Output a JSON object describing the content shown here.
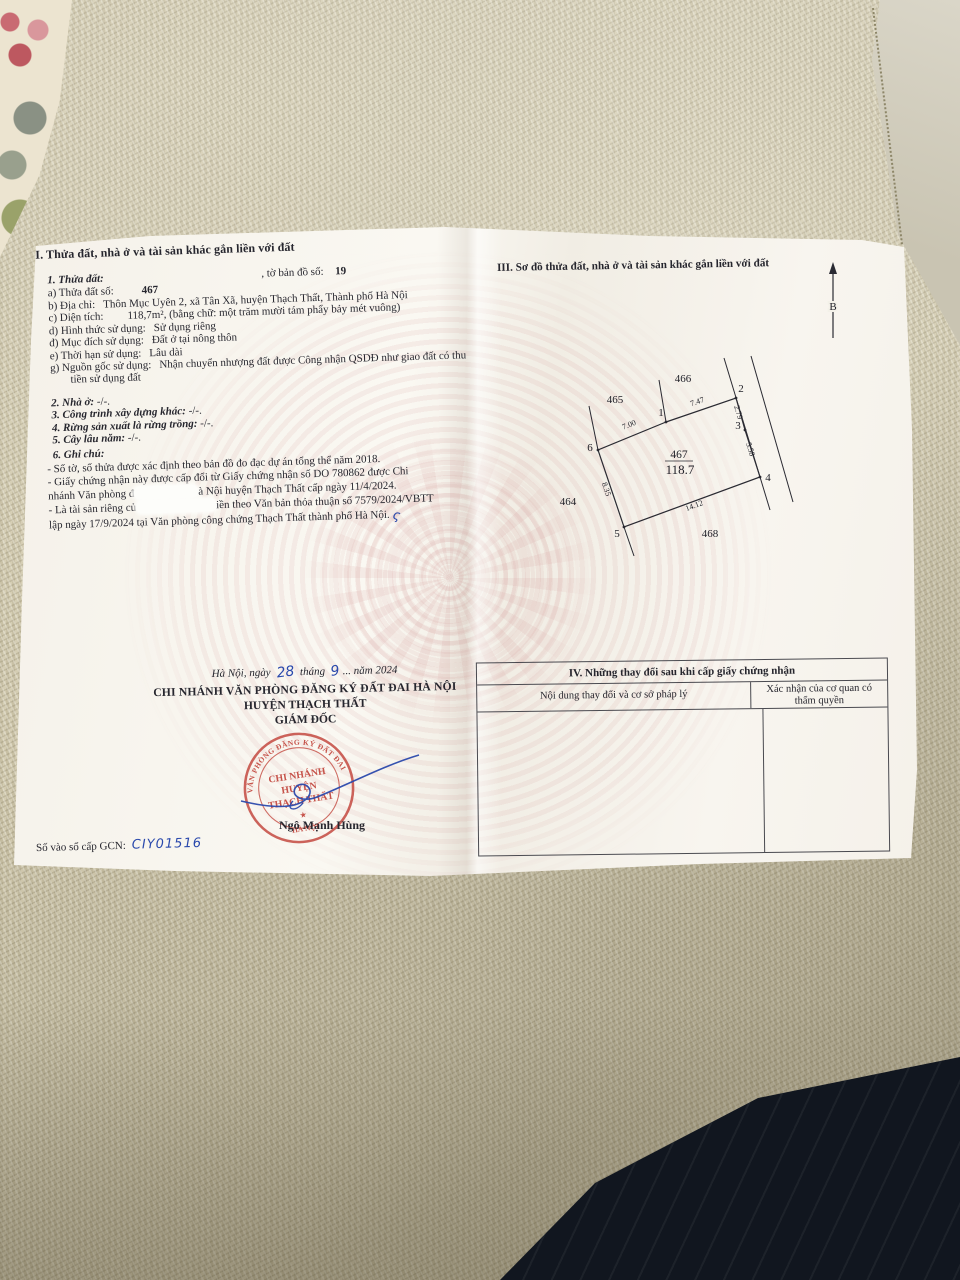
{
  "certificate": {
    "section2": {
      "title": "II. Thửa đất, nhà ở và tài sản khác gắn liền với đất",
      "parcel": {
        "heading": "1. Thửa đất:",
        "map_sheet_label": ", tờ bản đồ số:",
        "map_sheet_value": "19",
        "fields": [
          {
            "label": "a) Thửa đất số:",
            "value": "467",
            "bold": true
          },
          {
            "label": "b) Địa chỉ:",
            "value": "Thôn Mục Uyên 2, xã Tân Xã, huyện Thạch Thất, Thành phố Hà Nội"
          },
          {
            "label": "c) Diện tích:",
            "value": "118,7m², (bằng chữ: một trăm mười tám phẩy bảy mét vuông)"
          },
          {
            "label": "d) Hình thức sử dụng:",
            "value": "Sử dụng riêng"
          },
          {
            "label": "đ) Mục đích sử dụng:",
            "value": "Đất ở tại nông thôn"
          },
          {
            "label": "e) Thời hạn sử dụng:",
            "value": "Lâu dài"
          },
          {
            "label": "g) Nguồn gốc sử dụng:",
            "value": "Nhận chuyển nhượng đất được Công nhận QSDĐ như giao đất có thu tiền sử dụng đất"
          }
        ]
      },
      "items": [
        {
          "label": "2. Nhà ở:",
          "value": "-/-."
        },
        {
          "label": "3. Công trình xây dựng khác:",
          "value": "-/-."
        },
        {
          "label": "4. Rừng sản xuất là rừng trồng:",
          "value": "-/-."
        },
        {
          "label": "5. Cây lâu năm:",
          "value": "-/-."
        }
      ],
      "notes_heading": "6. Ghi chú:",
      "notes": [
        {
          "segments": [
            {
              "text": "- Số tờ, số thửa được xác định theo bản đồ đo đạc dự án tổng thể năm 2018."
            }
          ]
        },
        {
          "segments": [
            {
              "text": "- Giấy chứng nhận này được cấp đổi từ Giấy chứng nhận số DO 780862 được Chi"
            }
          ]
        },
        {
          "segments": [
            {
              "text": "nhánh Văn phòng đ"
            },
            {
              "redact": 64
            },
            {
              "text": "à Nội huyện Thạch Thất cấp ngày 11/4/2024."
            }
          ]
        },
        {
          "segments": [
            {
              "text": "- Là tài sản riêng củ"
            },
            {
              "redact": 80
            },
            {
              "text": "iền theo Văn bản thỏa thuận số 7579/2024/VBTT"
            }
          ]
        },
        {
          "segments": [
            {
              "text": "lập ngày 17/9/2024 tại Văn phòng công chứng Thạch Thất thành phố Hà Nội."
            },
            {
              "mark": "ς"
            }
          ]
        }
      ]
    },
    "section3": {
      "title": "III. Sơ đồ thửa đất, nhà ở và tài sản khác gắn liền với đất",
      "north_label": "B",
      "diagram": {
        "parcel_number": "467",
        "area": "118.7",
        "adjacent_parcels": [
          "465",
          "466",
          "464",
          "468"
        ],
        "vertices": [
          "1",
          "2",
          "3",
          "4",
          "5",
          "6"
        ],
        "edges": [
          {
            "vertices": "6-1",
            "length": "7.00"
          },
          {
            "vertices": "1-2",
            "length": "7.47"
          },
          {
            "vertices": "2-3",
            "length": "2.79"
          },
          {
            "vertices": "3-4",
            "length": "5.58"
          },
          {
            "vertices": "5-4",
            "length": "14.12"
          },
          {
            "vertices": "6-5",
            "length": "8.35"
          }
        ]
      }
    },
    "section4": {
      "title": "IV. Những thay đổi sau khi cấp giấy chứng nhận",
      "col_content": "Nội dung thay đổi và cơ sở pháp lý",
      "col_confirm": "Xác nhận của cơ quan có thẩm quyền"
    },
    "issuance": {
      "date_prefix": "Hà Nội, ngày ",
      "day": "28",
      "date_mid": " tháng ",
      "month": "9",
      "date_suffix": "... năm 2024",
      "office_line1": "CHI NHÁNH VĂN PHÒNG ĐĂNG KÝ ĐẤT ĐAI HÀ NỘI",
      "office_line2": "HUYỆN THẠCH THẤT",
      "signer_title": "GIÁM ĐỐC",
      "signer_name": "Ngô Mạnh Hùng",
      "stamp": {
        "ring_top": "VĂN PHÒNG ĐĂNG KÝ ĐẤT ĐAI",
        "ring_bottom": "HÀ NỘI",
        "line1": "CHI NHÁNH",
        "line2": "HUYỆN",
        "line3": "THẠCH THẤT",
        "star": "★"
      }
    },
    "registry": {
      "label": "Số vào sổ cấp GCN:",
      "value": "CIY01516"
    }
  },
  "colors": {
    "stamp_red": "#c2453c",
    "ink_blue": "#2a49ac",
    "guilloche_pink": "#e7c9c9",
    "paper": "#f6f3ec",
    "fabric_beige": "#cdc5ab",
    "dark_fabric_navy": "#1c2330"
  }
}
